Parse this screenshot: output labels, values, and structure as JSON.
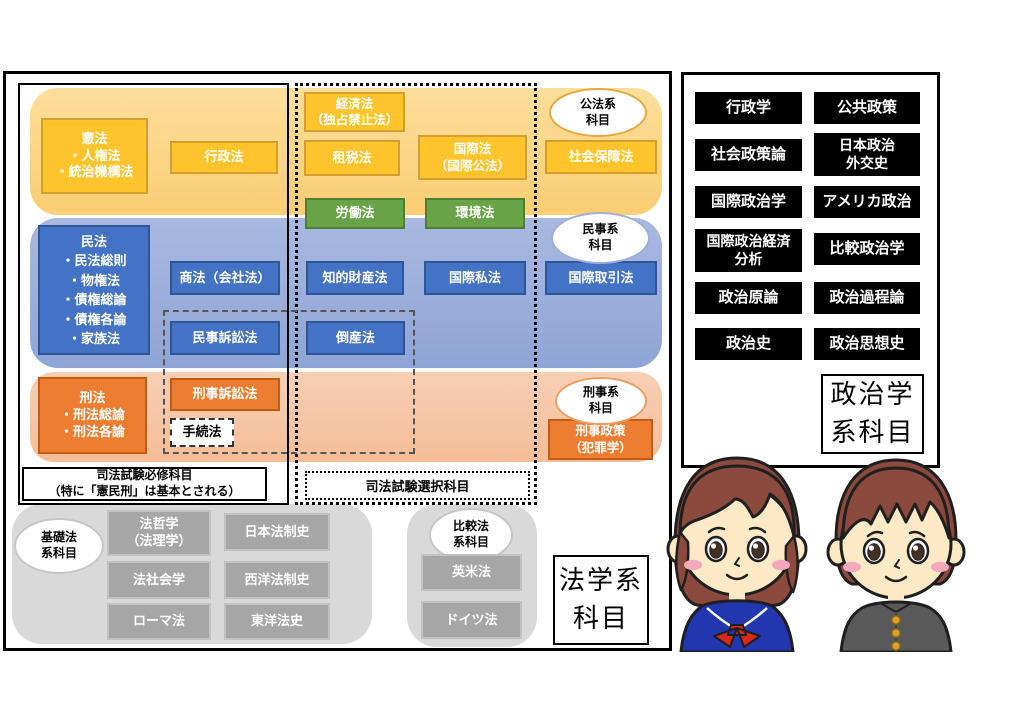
{
  "law": {
    "public": {
      "tag": "公法系\n科目",
      "kenpou": "憲法\n・人権法\n・統治機構法",
      "gyousei": "行政法",
      "keizai": "経済法\n（独占禁止法）",
      "sozei": "租税法",
      "kokusaihou": "国際法\n（国際公法）",
      "shakaihoshou": "社会保障法",
      "roudou": "労働法",
      "kankyou": "環境法"
    },
    "civil": {
      "tag": "民事系\n科目",
      "minpou": "民法\n・民法総則\n・物権法\n・債権総論\n・債権各論\n・家族法",
      "shouhou": "商法（会社法）",
      "chizai": "知的財産法",
      "kokusaishihou": "国際私法",
      "kokusaitorihiki": "国際取引法",
      "minso": "民事訴訟法",
      "tousan": "倒産法"
    },
    "criminal": {
      "tag": "刑事系\n科目",
      "keihou": "刑法\n・刑法総論\n・刑法各論",
      "keiso": "刑事訴訟法",
      "tetsuzuki": "手続法",
      "keijiseisaku": "刑事政策\n（犯罪学）"
    },
    "exam": {
      "required": "司法試験必修科目\n（特に「憲民刑」は基本とされる）",
      "elective": "司法試験選択科目"
    },
    "basic": {
      "tag": "基礎法\n系科目",
      "items": [
        "法哲学\n（法理学）",
        "日本法制史",
        "法社会学",
        "西洋法制史",
        "ローマ法",
        "東洋法史"
      ]
    },
    "comparative": {
      "tag": "比較法\n系科目",
      "items": [
        "英米法",
        "ドイツ法"
      ]
    },
    "title": "法学系\n科目"
  },
  "politics": {
    "items": [
      "行政学",
      "公共政策",
      "社会政策論",
      "日本政治\n外交史",
      "国際政治学",
      "アメリカ政治",
      "国際政治経済\n分析",
      "比較政治学",
      "政治原論",
      "政治過程論",
      "政治史",
      "政治思想史"
    ],
    "title": "政治学\n系科目"
  },
  "colors": {
    "gold_box": "#FFC32B",
    "public_band": "#FBD180",
    "green_box": "#68A347",
    "blue_box": "#4472C4",
    "civil_band": "#93A9DA",
    "orange_box": "#ED7D31",
    "criminal_band": "#F6C3A4",
    "gray_box": "#A6A6A6",
    "gray_band": "#D9D9D9",
    "politics_box": "#000000"
  },
  "illustrations": {
    "girl": "female-student-sailor-uniform",
    "boy": "male-student-gakuran"
  }
}
